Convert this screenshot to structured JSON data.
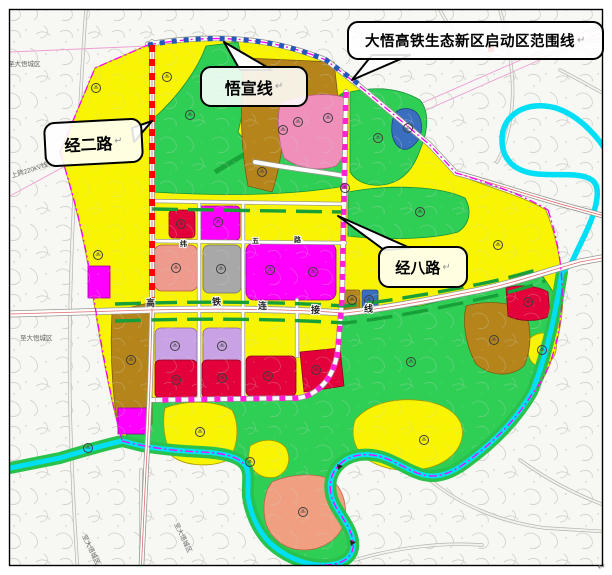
{
  "map": {
    "callouts": {
      "scope_line": "大悟高铁生态新区启动区范围线",
      "wuxuan_line": "悟宣线",
      "jing_er_road": "经二路",
      "jing_ba_road": "经八路"
    },
    "road_name_chars": {
      "hsr_link": [
        "高",
        "铁",
        "连",
        "接",
        "线"
      ],
      "wei_wu_road": [
        "纬",
        "五",
        "路"
      ]
    },
    "edge_labels": {
      "top_left": "至大悟城区",
      "west": "至大悟城区",
      "power_line": "上跨220kV线",
      "bottom_1": "至大悟城区",
      "bottom_2": "至大悟城区"
    },
    "marks": {
      "return_mark": "↵"
    },
    "colors": {
      "residential_yellow": "#f8f402",
      "park_green": "#2fcf56",
      "industrial_brown": "#b5851b",
      "commercial_red": "#e4003a",
      "mixed_magenta": "#ff00ff",
      "pink_zone": "#ef8fba",
      "lilac_zone": "#c9a2e6",
      "salmon_zone": "#f0a080",
      "gray_zone": "#a8a8a8",
      "river_cyan": "#00dff5",
      "boundary_magenta": "#ff00ff",
      "railway_blue": "#2458b8",
      "road_dash_red": "#ff0000"
    }
  }
}
